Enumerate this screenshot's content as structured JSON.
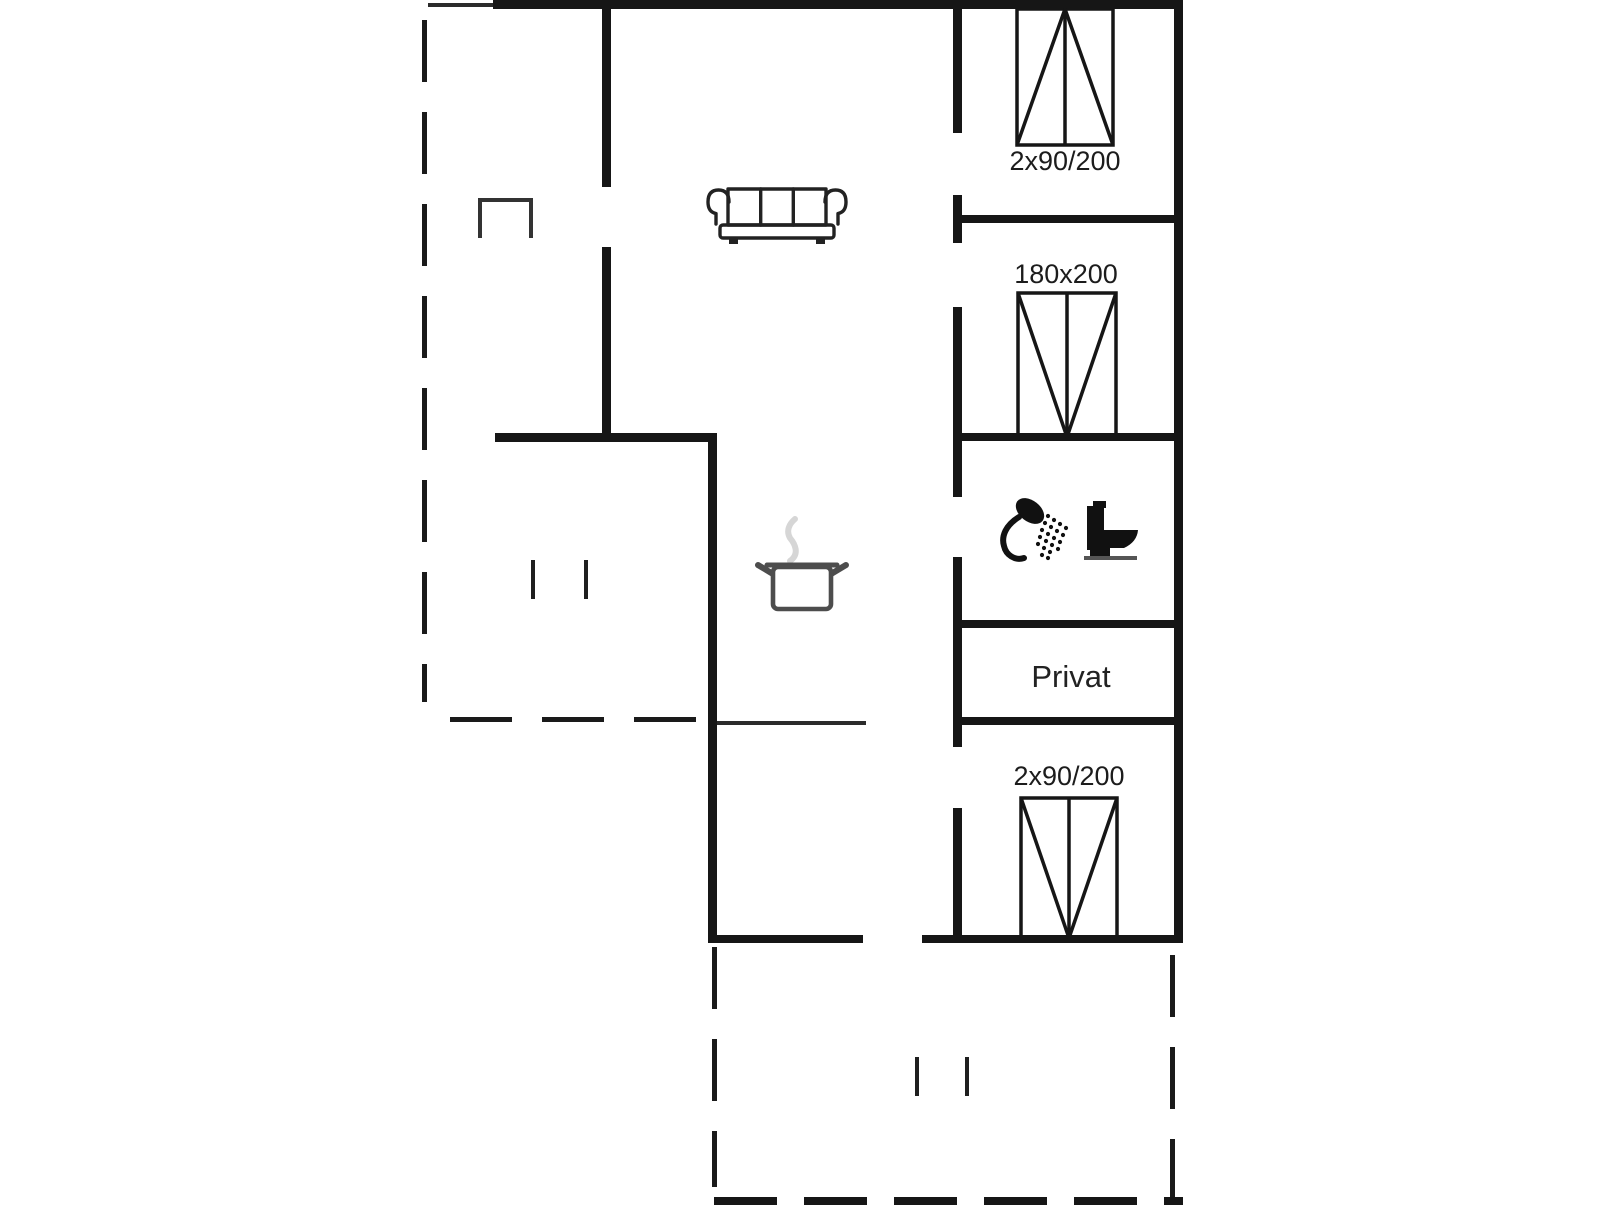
{
  "floorplan": {
    "background_color": "#ffffff",
    "wall_color": "#161616",
    "labels": {
      "bedroom_top_bed_size": "2x90/200",
      "bedroom_middle_bed_size": "180x200",
      "bedroom_bottom_bed_size": "2x90/200",
      "private_room": "Privat"
    },
    "icons": {
      "sofa": "sofa-icon",
      "cooking_pot": "cooking-pot-icon",
      "shower": "shower-icon",
      "toilet": "toilet-icon",
      "beds": "double-bed-icon",
      "chair": "chair-icon"
    },
    "accent_colors": {
      "pot_outline": "#4d4d4d",
      "steam": "#d6d6d6"
    }
  }
}
